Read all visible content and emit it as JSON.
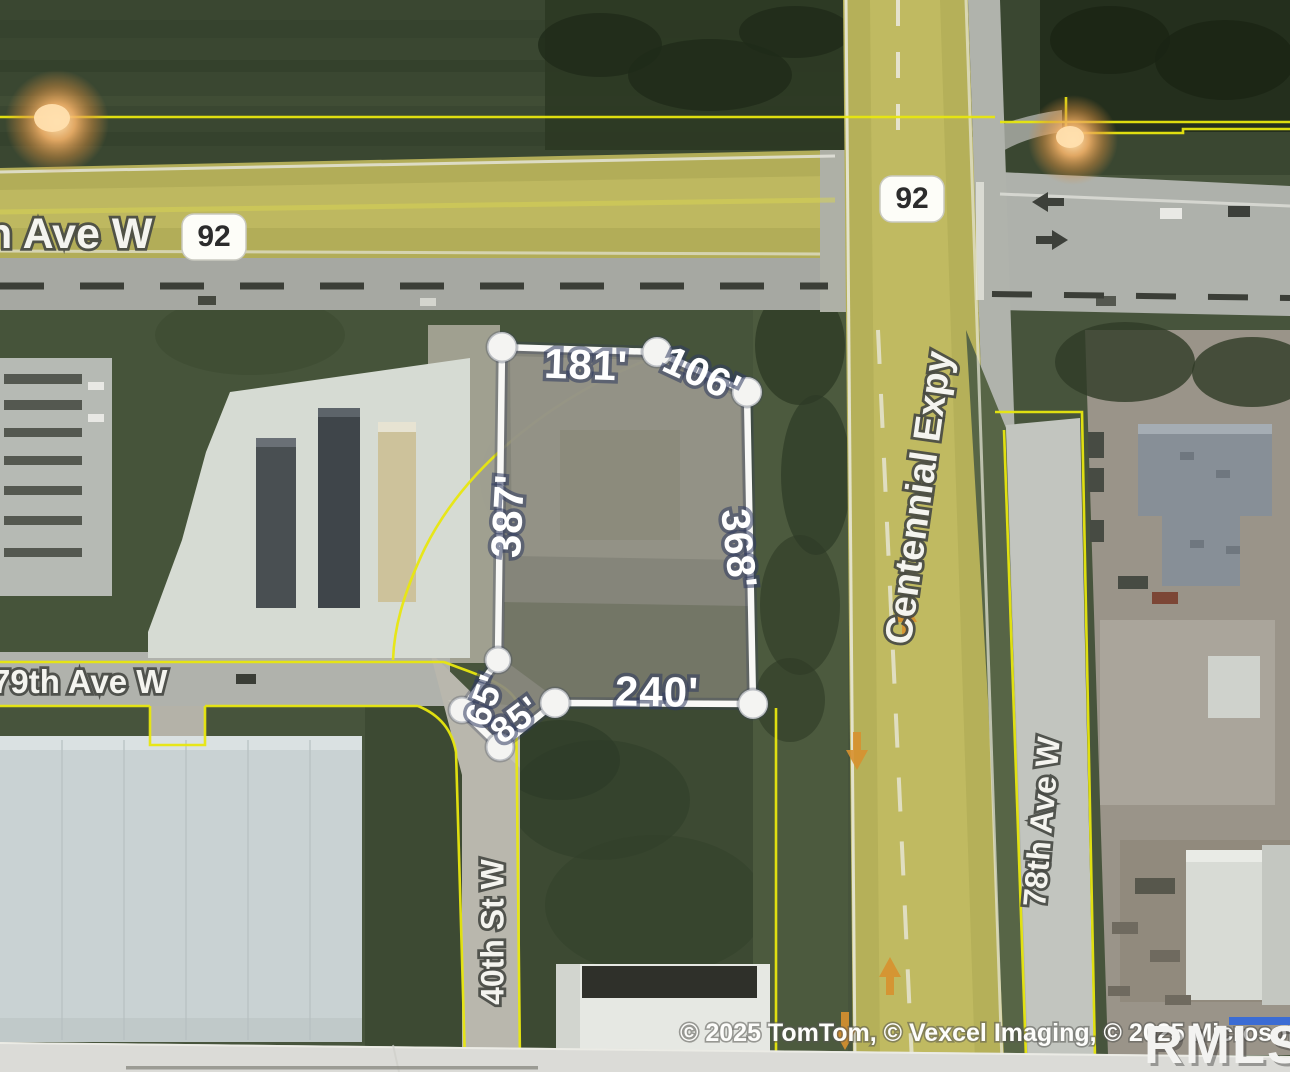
{
  "map": {
    "route_badges": [
      {
        "label": "92"
      },
      {
        "label": "92"
      }
    ],
    "road_labels": {
      "ave_w_partial": "n Ave W",
      "centennial_expy": "Centennial Expy",
      "ave_79": "79th Ave W",
      "st_40": "40th St W",
      "ave_78": "78th Ave W"
    },
    "parcel_dimensions": {
      "top": "181'",
      "top_right": "106'",
      "left": "387'",
      "right": "368'",
      "bottom": "240'",
      "bottom_left_diag": "85'",
      "bottom_left_steep": "65'"
    },
    "attribution": "© 2025 TomTom, © Vexcel Imaging, © 2025 Microsoft Corpor",
    "watermark": "RMLSA",
    "colors": {
      "boundary_yellow": "#e8e70f",
      "parcel_outline": "#f8f8f6",
      "field_green": "#47543c",
      "highway_tint": "#b2ad58",
      "road_gray": "#aeb0ab",
      "glow_orange": "#f3b269",
      "watermark_blue_bar": "#3b6cd4"
    }
  }
}
